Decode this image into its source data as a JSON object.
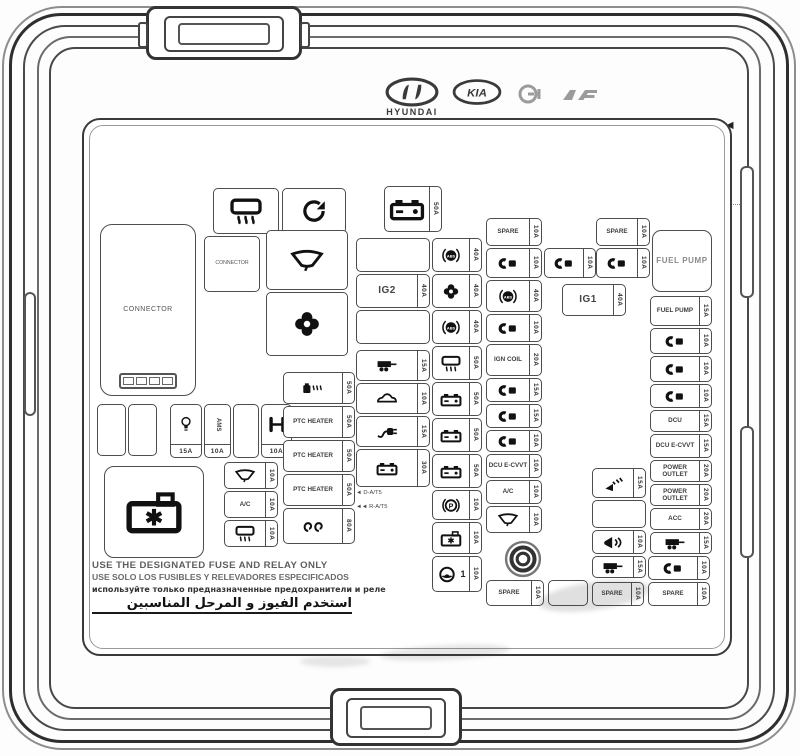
{
  "cover": {
    "part_number": "91955-S1040",
    "model_code": "►PP-TD20◄",
    "barcode_label": "BAR CODE",
    "brand_text": "HYUNDAI",
    "kia_text": "KIA",
    "warnings": {
      "en": "USE THE DESIGNATED FUSE AND RELAY ONLY",
      "es": "USE SOLO LOS FUSIBLES Y RELEVADORES ESPECIFICADOS",
      "ru": "используйте только предназначенные предохранители и реле",
      "ar": "استخدم الفيوز و المرحل المناسبين"
    },
    "colors": {
      "line": "#3a3a3a",
      "text": "#333333",
      "background": "#ffffff"
    }
  },
  "cells": [
    {
      "name": "rear-defrost-cell",
      "icon": "rear-defrost",
      "pos": [
        213,
        188,
        66,
        46
      ],
      "cls": "lg"
    },
    {
      "name": "rotate-cell",
      "icon": "rotate",
      "pos": [
        282,
        188,
        64,
        46
      ],
      "cls": "lg"
    },
    {
      "name": "battery-feed-cell",
      "icon": "battery",
      "amp": "50A",
      "pos": [
        384,
        186,
        58,
        46
      ],
      "cls": "lg"
    },
    {
      "name": "connector-box",
      "label": "CONNECTOR",
      "pos": [
        100,
        224,
        96,
        172
      ],
      "cls": "connector-big"
    },
    {
      "name": "connector-cell",
      "label": "CONNECTOR",
      "pos": [
        204,
        236,
        56,
        56
      ],
      "cls": "connector-small"
    },
    {
      "name": "wiper-cell",
      "icon": "wiper",
      "pos": [
        266,
        230,
        82,
        60
      ],
      "cls": "lg"
    },
    {
      "name": "fan-cell",
      "icon": "fan",
      "pos": [
        266,
        292,
        82,
        64
      ],
      "cls": "lg"
    },
    {
      "name": "blank-cell",
      "pos": [
        356,
        238,
        74,
        34
      ]
    },
    {
      "name": "ig2-cell",
      "label": "IG2",
      "amp": "40A",
      "pos": [
        356,
        274,
        74,
        34
      ],
      "cls": "big-label"
    },
    {
      "name": "blank-cell",
      "pos": [
        356,
        310,
        74,
        34
      ]
    },
    {
      "name": "trailer-cell",
      "icon": "trailer",
      "amp": "15A",
      "pos": [
        356,
        350,
        74,
        31
      ]
    },
    {
      "name": "car-cell",
      "icon": "car",
      "amp": "10A",
      "pos": [
        356,
        383,
        74,
        31
      ]
    },
    {
      "name": "plug-cell",
      "icon": "plug",
      "amp": "15A",
      "pos": [
        356,
        416,
        74,
        31
      ]
    },
    {
      "name": "battery-cell",
      "icon": "battery",
      "amp": "30A",
      "pos": [
        356,
        449,
        74,
        38
      ]
    },
    {
      "name": "at-note",
      "label": "◄ D-A/T5",
      "label2": "◄◄ R-A/T5",
      "pos": [
        356,
        490,
        74,
        26
      ],
      "cls": "note"
    },
    {
      "name": "abs-cell",
      "icon": "abs",
      "amp": "40A",
      "pos": [
        432,
        238,
        50,
        34
      ]
    },
    {
      "name": "fan-fuse-cell",
      "icon": "fan",
      "amp": "40A",
      "pos": [
        432,
        274,
        50,
        34
      ]
    },
    {
      "name": "abs-cell",
      "icon": "abs",
      "amp": "40A",
      "pos": [
        432,
        310,
        50,
        34
      ]
    },
    {
      "name": "defrost-fuse-cell",
      "icon": "rear-defrost",
      "amp": "50A",
      "pos": [
        432,
        346,
        50,
        34
      ]
    },
    {
      "name": "battery-cell",
      "icon": "battery",
      "amp": "50A",
      "pos": [
        432,
        382,
        50,
        34
      ]
    },
    {
      "name": "battery-cell",
      "icon": "battery",
      "amp": "50A",
      "pos": [
        432,
        418,
        50,
        34
      ]
    },
    {
      "name": "battery-cell",
      "icon": "battery",
      "amp": "50A",
      "pos": [
        432,
        454,
        50,
        34
      ]
    },
    {
      "name": "parking-brake-cell",
      "icon": "p-brake",
      "amp": "10A",
      "pos": [
        432,
        490,
        50,
        30
      ]
    },
    {
      "name": "battery-star-cell",
      "icon": "battery-star",
      "amp": "10A",
      "pos": [
        432,
        522,
        50,
        32
      ]
    },
    {
      "name": "steering-cell",
      "icon": "steering",
      "suffix": "1",
      "amp": "10A",
      "pos": [
        432,
        556,
        50,
        36
      ]
    },
    {
      "name": "blank-cell",
      "pos": [
        97,
        404,
        29,
        52
      ]
    },
    {
      "name": "blank-cell",
      "pos": [
        128,
        404,
        29,
        52
      ]
    },
    {
      "name": "bulb-cell",
      "icon": "bulb",
      "amp": "15A",
      "ampSide": "b",
      "pos": [
        170,
        404,
        32,
        54
      ]
    },
    {
      "name": "ams-cell",
      "label": "AMS",
      "amp": "10A",
      "ampSide": "b",
      "pos": [
        204,
        404,
        27,
        54
      ],
      "cls": "vlabel"
    },
    {
      "name": "blank-cell",
      "pos": [
        233,
        404,
        26,
        54
      ]
    },
    {
      "name": "drivetrain-cell",
      "icon": "drivetrain",
      "amp": "10A",
      "ampSide": "b",
      "pos": [
        261,
        404,
        31,
        54
      ]
    },
    {
      "name": "battery-star-box",
      "icon": "battery-star",
      "pos": [
        104,
        466,
        100,
        92
      ],
      "cls": "big-box"
    },
    {
      "name": "wiper-fuse-cell",
      "icon": "wiper",
      "amp": "10A",
      "pos": [
        224,
        462,
        54,
        27
      ]
    },
    {
      "name": "ac-cell",
      "label": "A/C",
      "amp": "10A",
      "pos": [
        224,
        491,
        54,
        27
      ]
    },
    {
      "name": "mirror-defrost-cell",
      "icon": "rear-defrost",
      "amp": "10A",
      "pos": [
        224,
        520,
        54,
        27
      ]
    },
    {
      "name": "fuel-heater-cell",
      "icon": "fuel-heat",
      "amp": "50A",
      "pos": [
        283,
        372,
        72,
        32
      ]
    },
    {
      "name": "ptc-heater-cell",
      "label": "PTC HEATER",
      "amp": "50A",
      "pos": [
        283,
        406,
        72,
        32
      ]
    },
    {
      "name": "ptc-heater-cell",
      "label": "PTC HEATER",
      "amp": "50A",
      "pos": [
        283,
        440,
        72,
        32
      ]
    },
    {
      "name": "ptc-heater-cell",
      "label": "PTC HEATER",
      "amp": "50A",
      "pos": [
        283,
        474,
        72,
        32
      ]
    },
    {
      "name": "glow-plug-cell",
      "icon": "glow-plug",
      "amp": "80A",
      "pos": [
        283,
        508,
        72,
        36
      ]
    },
    {
      "name": "spare-cell",
      "label": "SPARE",
      "amp": "10A",
      "pos": [
        486,
        218,
        56,
        28
      ]
    },
    {
      "name": "fuse-cell",
      "icon": "fuse",
      "amp": "10A",
      "pos": [
        486,
        248,
        56,
        30
      ]
    },
    {
      "name": "abs-cell",
      "icon": "abs",
      "amp": "40A",
      "pos": [
        486,
        280,
        56,
        32
      ]
    },
    {
      "name": "fuse-cell",
      "icon": "fuse",
      "amp": "10A",
      "pos": [
        486,
        314,
        56,
        28
      ]
    },
    {
      "name": "ign-coil-cell",
      "label": "IGN COIL",
      "amp": "20A",
      "pos": [
        486,
        344,
        56,
        32
      ]
    },
    {
      "name": "fuse-cell",
      "icon": "fuse",
      "amp": "15A",
      "pos": [
        486,
        378,
        56,
        24
      ]
    },
    {
      "name": "fuse-cell",
      "icon": "fuse",
      "amp": "15A",
      "pos": [
        486,
        404,
        56,
        24
      ]
    },
    {
      "name": "fuse-cell",
      "icon": "fuse",
      "amp": "10A",
      "pos": [
        486,
        430,
        56,
        22
      ]
    },
    {
      "name": "dcu-ecvvt-cell",
      "label": "DCU E-CVVT",
      "amp": "10A",
      "pos": [
        486,
        454,
        56,
        24
      ]
    },
    {
      "name": "ac-cell",
      "label": "A/C",
      "amp": "10A",
      "pos": [
        486,
        480,
        56,
        24
      ]
    },
    {
      "name": "wiper-fuse-cell",
      "icon": "wiper",
      "amp": "10A",
      "pos": [
        486,
        506,
        56,
        27
      ]
    },
    {
      "name": "mounting-stud",
      "icon": "nut",
      "pos": [
        500,
        538,
        46,
        42
      ],
      "cls": "nut-cell"
    },
    {
      "name": "fuse-cell",
      "icon": "fuse",
      "amp": "10A",
      "pos": [
        544,
        248,
        52,
        30
      ]
    },
    {
      "name": "spare-cell",
      "label": "SPARE",
      "amp": "10A",
      "pos": [
        596,
        218,
        54,
        28
      ]
    },
    {
      "name": "fuse-cell",
      "icon": "fuse",
      "amp": "10A",
      "pos": [
        596,
        248,
        54,
        30
      ]
    },
    {
      "name": "ig1-cell",
      "label": "IG1",
      "amp": "40A",
      "pos": [
        562,
        284,
        64,
        32
      ],
      "cls": "big-label"
    },
    {
      "name": "washer-cell",
      "icon": "washer",
      "amp": "15A",
      "pos": [
        592,
        468,
        54,
        30
      ]
    },
    {
      "name": "blank-cell",
      "pos": [
        592,
        500,
        54,
        28
      ]
    },
    {
      "name": "horn-cell",
      "icon": "horn",
      "amp": "10A",
      "pos": [
        592,
        530,
        54,
        24
      ]
    },
    {
      "name": "trailer-cell",
      "icon": "trailer",
      "amp": "15A",
      "pos": [
        592,
        556,
        54,
        22
      ]
    },
    {
      "name": "fuel-pump-relay",
      "label": "FUEL PUMP",
      "pos": [
        652,
        230,
        60,
        62
      ],
      "cls": "relay"
    },
    {
      "name": "fuel-pump-cell",
      "label": "FUEL PUMP",
      "amp": "15A",
      "pos": [
        650,
        296,
        62,
        30
      ]
    },
    {
      "name": "fuse-cell",
      "icon": "fuse",
      "amp": "10A",
      "pos": [
        650,
        328,
        62,
        26
      ]
    },
    {
      "name": "fuse-cell",
      "icon": "fuse",
      "amp": "10A",
      "pos": [
        650,
        356,
        62,
        26
      ]
    },
    {
      "name": "fuse-cell",
      "icon": "fuse",
      "amp": "10A",
      "pos": [
        650,
        384,
        62,
        24
      ]
    },
    {
      "name": "dcu-cell",
      "label": "DCU",
      "amp": "15A",
      "pos": [
        650,
        410,
        62,
        22
      ]
    },
    {
      "name": "dcu-ecvvt-cell",
      "label": "DCU E-CVVT",
      "amp": "15A",
      "pos": [
        650,
        434,
        62,
        24
      ]
    },
    {
      "name": "power-outlet-cell",
      "label": "POWER OUTLET",
      "amp": "20A",
      "pos": [
        650,
        460,
        62,
        22
      ]
    },
    {
      "name": "power-outlet-cell",
      "label": "POWER OUTLET",
      "amp": "20A",
      "pos": [
        650,
        484,
        62,
        22
      ]
    },
    {
      "name": "acc-cell",
      "label": "ACC",
      "amp": "20A",
      "pos": [
        650,
        508,
        62,
        22
      ]
    },
    {
      "name": "trailer-cell",
      "icon": "trailer",
      "amp": "15A",
      "pos": [
        650,
        532,
        62,
        22
      ]
    },
    {
      "name": "fuse-cell",
      "icon": "fuse",
      "amp": "10A",
      "pos": [
        648,
        556,
        62,
        24
      ]
    },
    {
      "name": "spare-cell",
      "label": "SPARE",
      "amp": "10A",
      "pos": [
        648,
        582,
        62,
        24
      ]
    },
    {
      "name": "spare-cell",
      "label": "SPARE",
      "amp": "10A",
      "pos": [
        486,
        580,
        58,
        26
      ]
    },
    {
      "name": "blank-cell",
      "pos": [
        548,
        580,
        40,
        26
      ]
    },
    {
      "name": "spare-cell",
      "label": "SPARE",
      "amp": "10A",
      "pos": [
        592,
        582,
        52,
        24
      ]
    }
  ]
}
